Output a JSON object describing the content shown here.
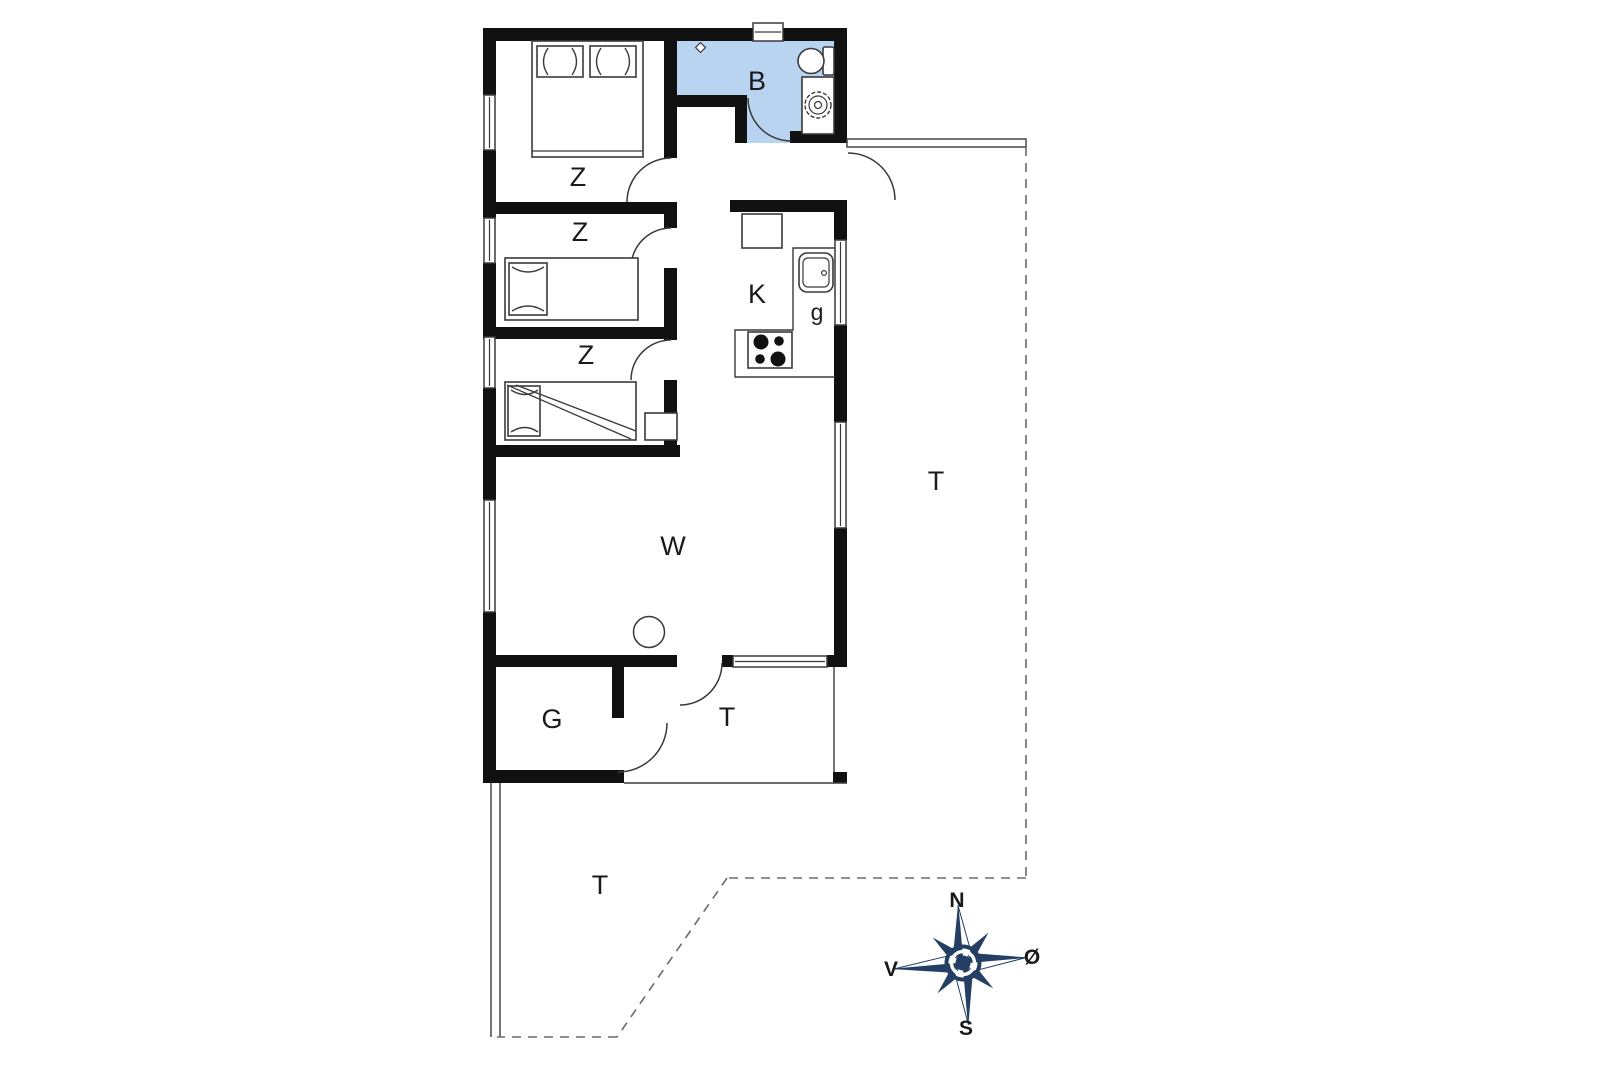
{
  "title": "Holiday house floor plan",
  "colors": {
    "wall": "#111111",
    "line": "#3a3a3a",
    "dashed": "#6b6b6b",
    "bathroom_fill": "#b9d4f1",
    "compass_navy": "#243f63",
    "background": "#ffffff"
  },
  "labels": {
    "bedroom1": "Z",
    "bedroom2": "Z",
    "bedroom3": "Z",
    "bathroom": "B",
    "kitchen": "K",
    "kitchen_sink": "g",
    "living_room": "W",
    "storage": "G",
    "terrace_inner": "T",
    "terrace_east": "T",
    "terrace_south": "T"
  },
  "compass": {
    "north": "N",
    "south": "S",
    "west": "V",
    "east": "Ø"
  }
}
